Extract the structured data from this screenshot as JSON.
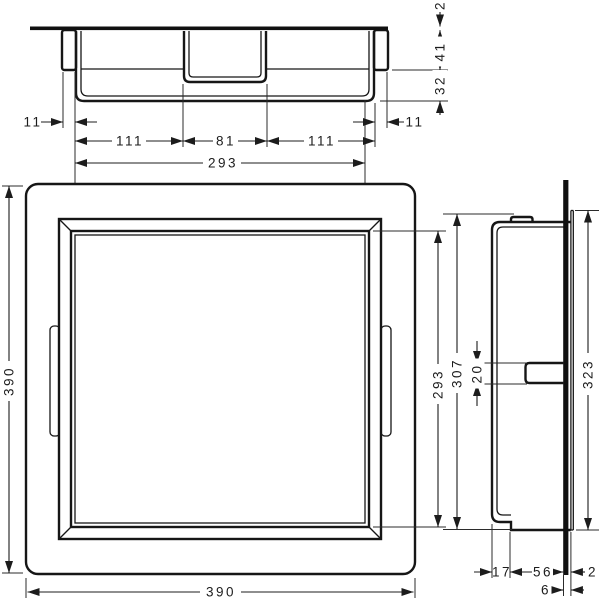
{
  "drawing": {
    "product": "recessed wall niche technical drawing",
    "units": "mm",
    "top_view": {
      "overhang_left": "11",
      "inner_left": "111",
      "inner_center": "81",
      "inner_right": "111",
      "overhang_right": "11",
      "inner_width": "293",
      "plate_proud": "2",
      "frame_depth": "41",
      "body_depth": "32"
    },
    "front_view": {
      "outer_height": "390",
      "outer_width": "390",
      "opening_height": "293"
    },
    "side_view": {
      "inner_height": "307",
      "clip_height": "20",
      "plate_height": "323",
      "back_gap": "17",
      "body_depth": "56",
      "plate_proud": "2",
      "lip_depth": "6"
    }
  }
}
